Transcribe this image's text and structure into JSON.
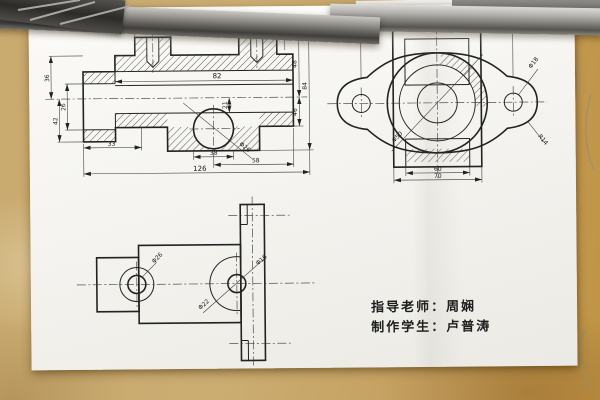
{
  "colors": {
    "wood": "#c8a96c",
    "paper": "#f5f4f0",
    "ink": "#222222",
    "metal_bar": "#9a9994"
  },
  "front_view": {
    "dims": {
      "top_span": "80",
      "top_right": "18",
      "boss_width": "30",
      "bore_length": "82",
      "left_upper": "36",
      "left_lower": "42",
      "left_bore": "26",
      "center_depth": "21",
      "right_upper": "48",
      "right_lower": "46",
      "right_overall": "84",
      "bottom_step": "33",
      "bottom_boss": "38",
      "bottom_right": "58",
      "overall_width": "126",
      "bore_dia": "Φ26"
    }
  },
  "side_view": {
    "dims": {
      "overall_width": "96",
      "bolt_hole": "Φ18",
      "lobe_radius": "R14",
      "bore_dia": "Φ50",
      "base_inner": "60",
      "base_outer": "70"
    }
  },
  "top_view": {
    "dims": {
      "left_bore": "Φ26",
      "main_bore": "Φ22",
      "right_hole": "Φ16"
    }
  },
  "credits": {
    "teacher": "指导老师：周娴",
    "student": "制作学生：卢普涛"
  }
}
